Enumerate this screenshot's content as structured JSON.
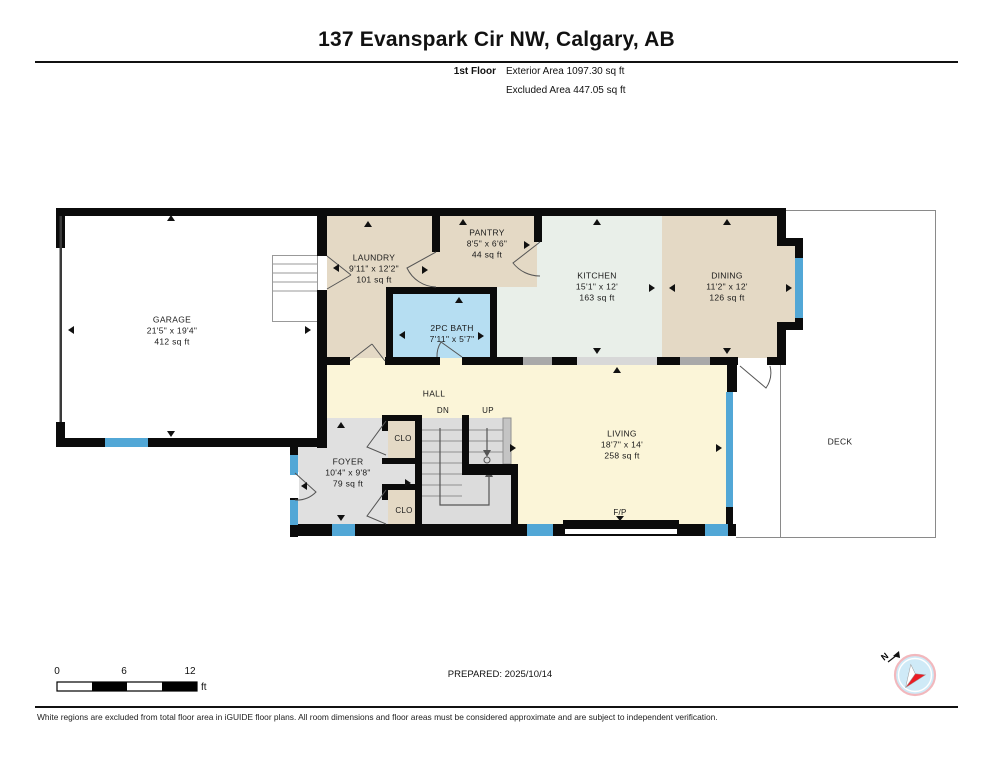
{
  "header": {
    "title": "137 Evanspark Cir NW, Calgary, AB",
    "floor_label": "1st Floor",
    "exterior_area": "Exterior Area 1097.30 sq ft",
    "excluded_area": "Excluded Area 447.05 sq ft"
  },
  "rooms": {
    "garage": {
      "name": "GARAGE",
      "dims": "21'5\" x 19'4\"",
      "area": "412 sq ft"
    },
    "laundry": {
      "name": "LAUNDRY",
      "dims": "9'11\" x 12'2\"",
      "area": "101 sq ft"
    },
    "pantry": {
      "name": "PANTRY",
      "dims": "8'5\" x 6'6\"",
      "area": "44 sq ft"
    },
    "bath": {
      "name": "2PC BATH",
      "dims": "7'11\" x 5'7\""
    },
    "kitchen": {
      "name": "KITCHEN",
      "dims": "15'1\" x 12'",
      "area": "163 sq ft"
    },
    "dining": {
      "name": "DINING",
      "dims": "11'2\" x 12'",
      "area": "126 sq ft"
    },
    "foyer": {
      "name": "FOYER",
      "dims": "10'4\" x 9'8\"",
      "area": "79 sq ft"
    },
    "living": {
      "name": "LIVING",
      "dims": "18'7\" x 14'",
      "area": "258 sq ft"
    }
  },
  "labels": {
    "hall": "HALL",
    "deck": "DECK",
    "closet": "CLO",
    "stairs_down": "DN",
    "stairs_up": "UP",
    "fireplace": "F/P"
  },
  "scale_bar": {
    "ticks": [
      "0",
      "6",
      "12"
    ],
    "unit": "ft"
  },
  "compass": {
    "north_label": "N"
  },
  "footer": {
    "prepared": "PREPARED: 2025/10/14",
    "disclaimer": "White regions are excluded from total floor area in iGUIDE floor plans. All room dimensions and floor areas must be considered approximate and are subject to independent verification."
  },
  "colors": {
    "wall": "#0b0b0b",
    "window_blue": "#52a7d6",
    "room_tan": "#e4d9c5",
    "room_mint": "#e9efe9",
    "room_yellow": "#fbf5d8",
    "room_bath_blue": "#b6def2",
    "room_gray": "#e0e0e0",
    "stairs_gray": "#dcdcdc",
    "excluded_white": "#ffffff",
    "compass_red": "#ea1c24",
    "compass_fill": "#cfeaf7"
  }
}
